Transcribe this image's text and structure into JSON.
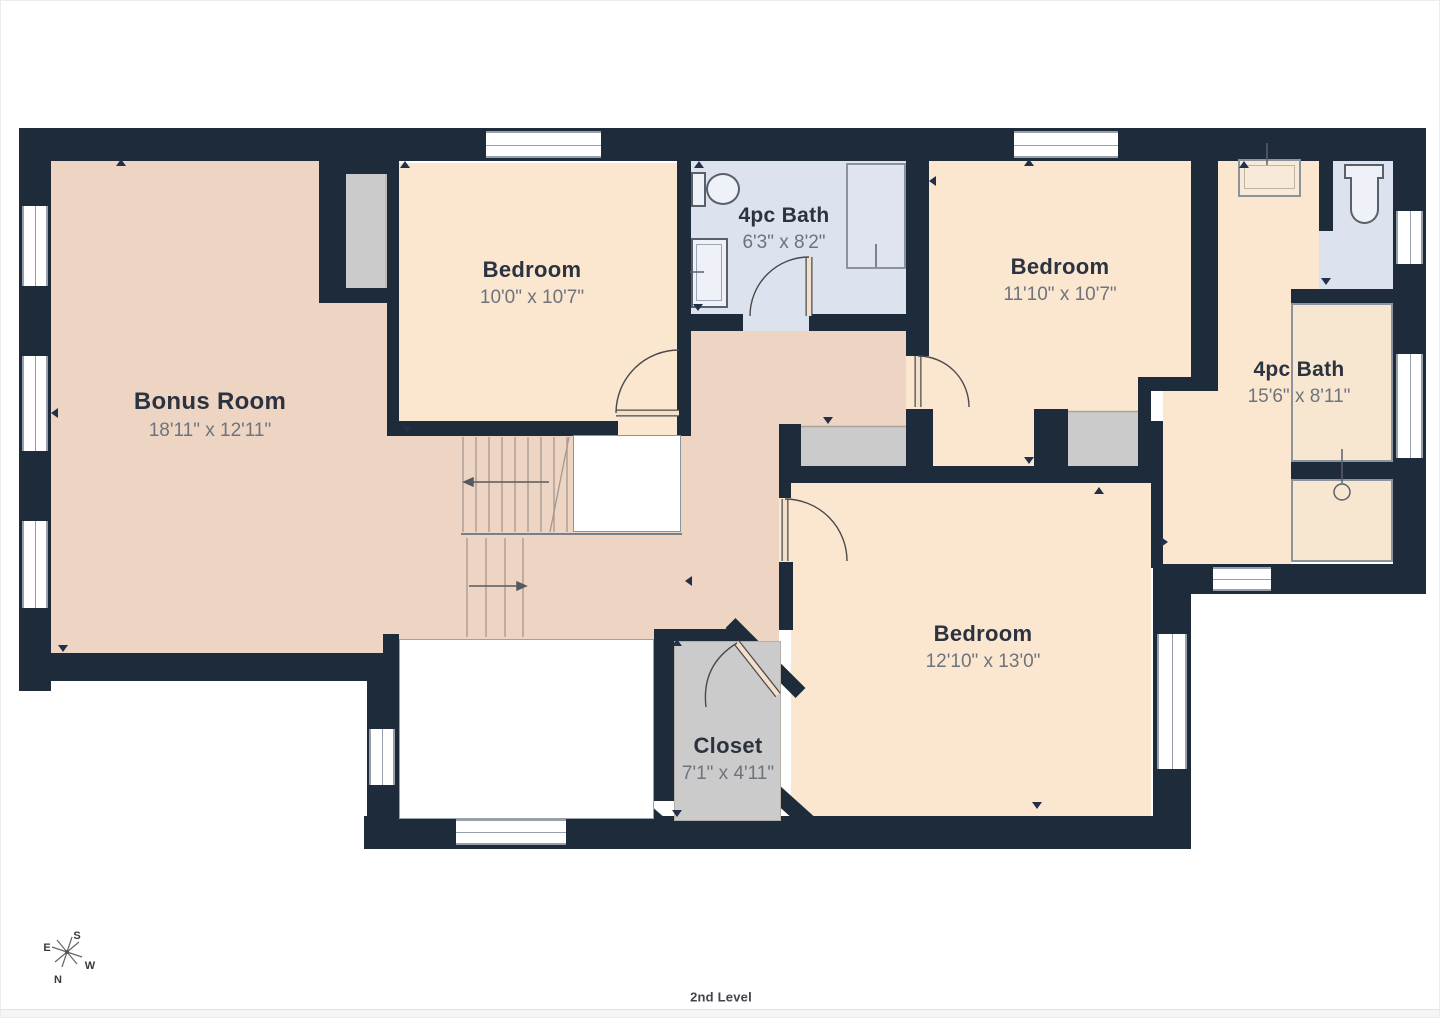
{
  "rooms": [
    {
      "name": "Bonus Room",
      "dims": "18'11\" x 12'11\""
    },
    {
      "name": "Bedroom",
      "dims": "10'0\" x 10'7\""
    },
    {
      "name": "4pc Bath",
      "dims": "6'3\" x 8'2\""
    },
    {
      "name": "Bedroom",
      "dims": "11'10\" x 10'7\""
    },
    {
      "name": "4pc Bath",
      "dims": "15'6\" x 8'11\""
    },
    {
      "name": "Bedroom",
      "dims": "12'10\" x 13'0\""
    },
    {
      "name": "Closet",
      "dims": "7'1\" x 4'11\""
    }
  ],
  "compass": {
    "n": "N",
    "s": "S",
    "e": "E",
    "w": "W"
  },
  "footer": {
    "level": "2nd Level"
  },
  "colors": {
    "wall": "#1e2b3a",
    "pink": "#eed5c3",
    "cream": "#fbe7d0",
    "blue": "#dce2ee",
    "gray": "#cbcbcb",
    "title": "#2b3240",
    "dims": "#6e737c",
    "stair": "#a5988c",
    "door": "#4a4a4a",
    "marker": "#22304a",
    "winline": "#98a0ab"
  }
}
